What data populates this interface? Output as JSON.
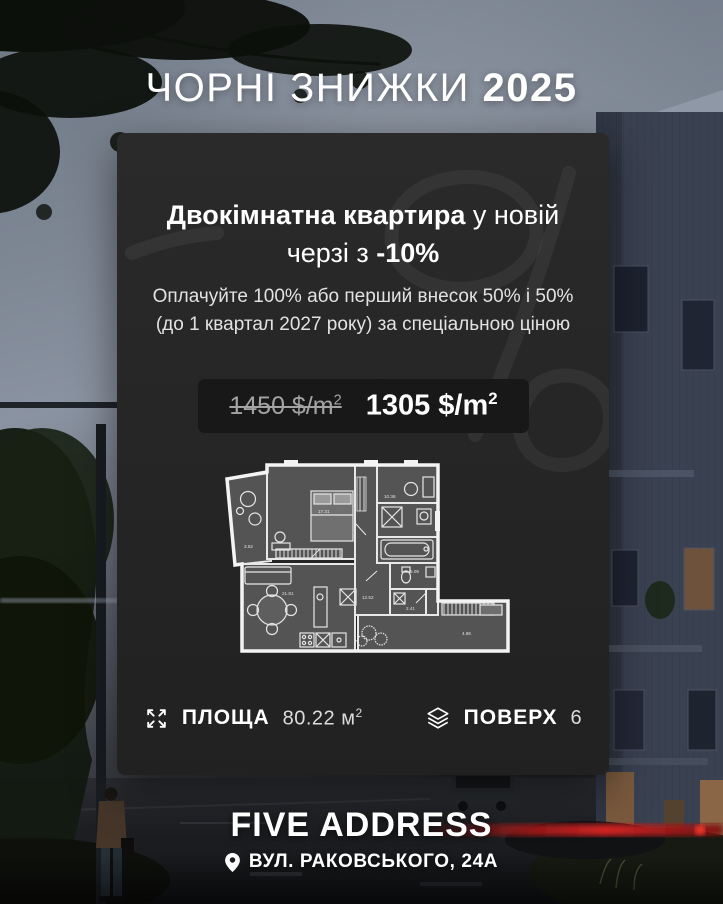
{
  "title": {
    "text": "ЧОРНІ ЗНИЖКИ",
    "year": "2025"
  },
  "card": {
    "watermark": "-10%",
    "heading": {
      "bold_start": "Двокімнатна квартира",
      "regular_end": " у новій",
      "line2_regular": "черзі з ",
      "line2_discount": "-10%"
    },
    "description": "Оплачуйте 100% або перший внесок 50% і 50% (до 1 квартал 2027 року) за спеціальною ціною",
    "pricing": {
      "old_price": "1450 $/m",
      "old_sup": "2",
      "new_price": "1305 $/m",
      "new_sup": "2"
    },
    "floor_plan": {
      "room_areas": {
        "balcony": "3.62",
        "bedroom": "17.31",
        "hall": "10.36",
        "bath": "5.09",
        "corridor": "12.52",
        "wc": "2.41",
        "living": "21.81",
        "loggia": "4.86"
      }
    },
    "stats": {
      "area_label": "ПЛОЩА",
      "area_value": "80.22 м",
      "area_sup": "2",
      "floor_label": "ПОВЕРХ",
      "floor_value": "6"
    }
  },
  "footer": {
    "brand": "FIVE ADDRESS",
    "address": "ВУЛ. РАКОВСЬКОГО, 24А"
  },
  "icons": {
    "area": "expand-icon",
    "floor": "layers-icon",
    "location": "location-pin-icon"
  },
  "colors": {
    "accent_red": "#c01e1c",
    "card_background": "#262626",
    "price_box_background": "#181818",
    "old_price_text": "#a3a3a3"
  }
}
